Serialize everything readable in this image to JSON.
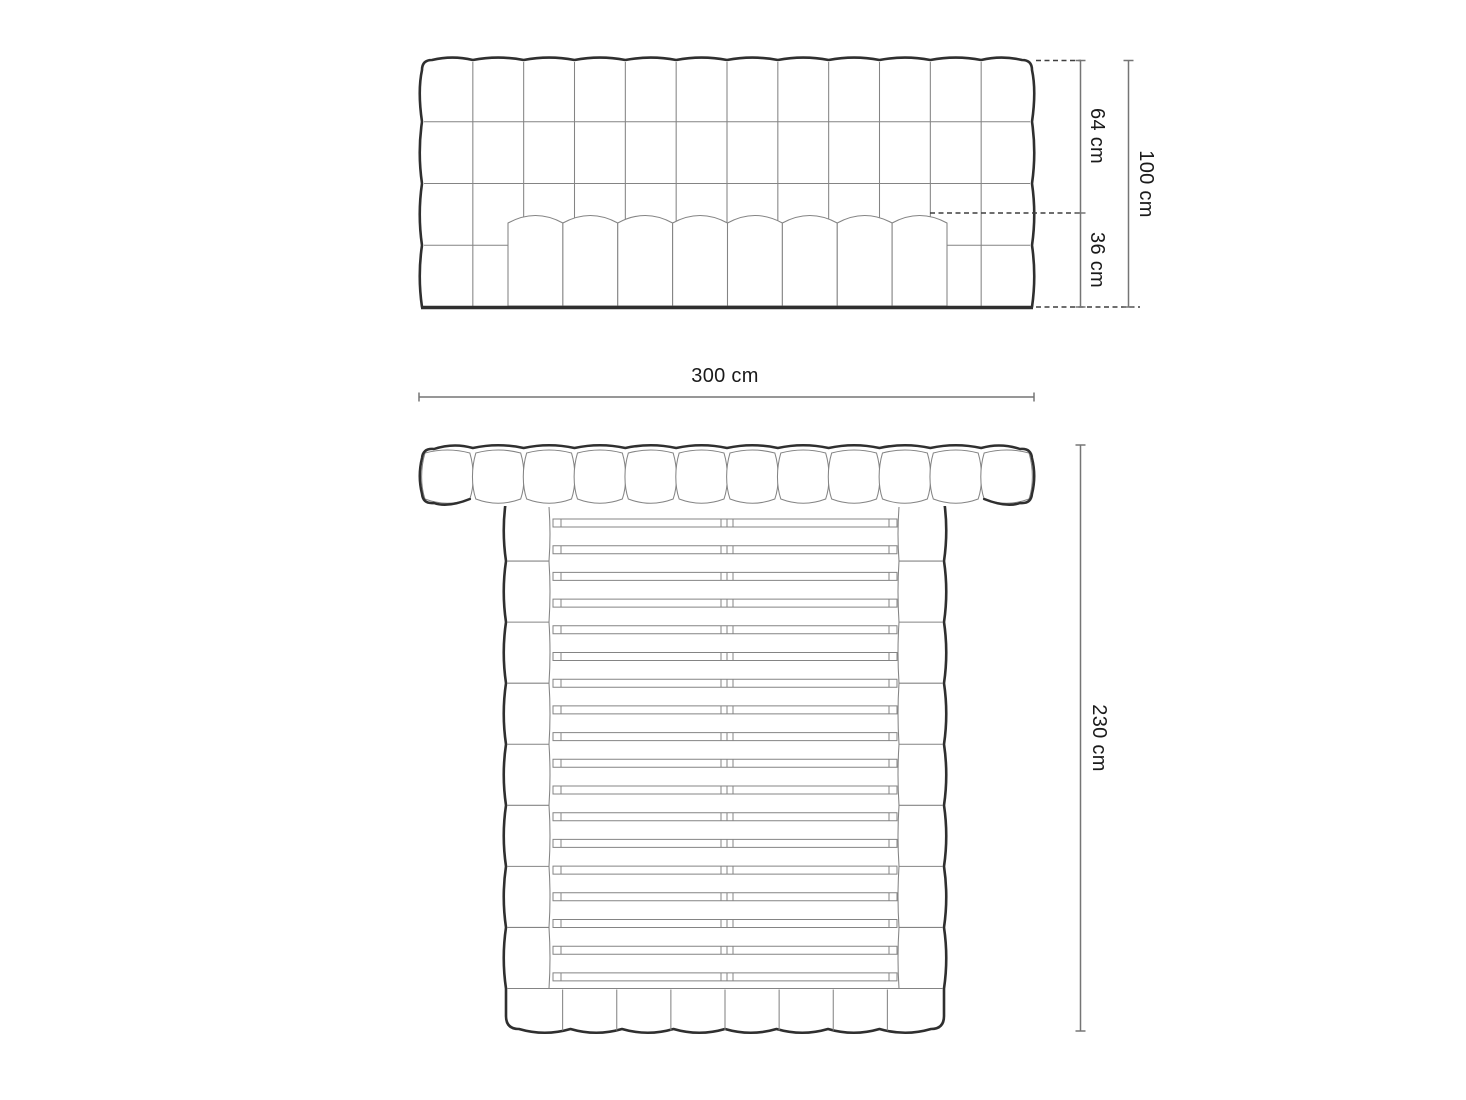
{
  "dimensions": {
    "front_upper": "64 cm",
    "front_lower": "36 cm",
    "front_total": "100 cm",
    "width": "300 cm",
    "length": "230 cm"
  },
  "diagram": {
    "headboard_columns": 12,
    "headboard_rows": 4,
    "mattress_channels": 8,
    "top_headboard_segments": 12,
    "side_rail_segments": 8,
    "footboard_segments": 8,
    "slat_count": 18,
    "colors": {
      "outline": "#2f2f2f",
      "thin_line": "#848484",
      "dimension_line": "#757575",
      "dashed_line": "#3f3f3f",
      "text": "#1a1a1a",
      "background": "#ffffff"
    }
  }
}
